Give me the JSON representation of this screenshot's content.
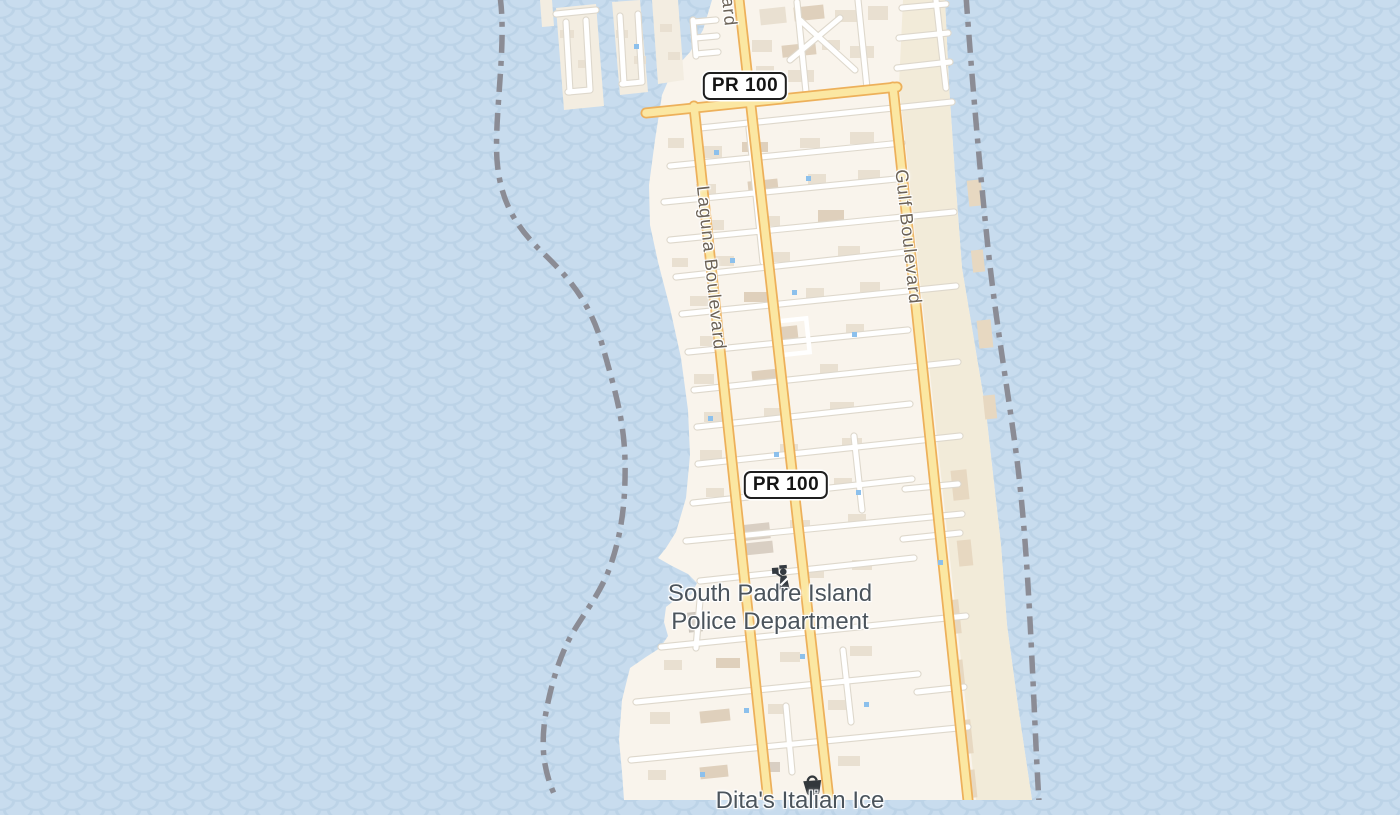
{
  "map": {
    "kind": "street-map",
    "area_shown": "South Padre Island",
    "road_labels": {
      "laguna": "Laguna Boulevard",
      "gulf": "Gulf Boulevard",
      "top_fragment": "ard"
    },
    "route_shields": [
      {
        "label": "PR 100"
      },
      {
        "label": "PR 100"
      }
    ],
    "pois": [
      {
        "label_line1": "South Padre Island",
        "label_line2": "Police Department",
        "icon": "police-officer-icon"
      },
      {
        "label": "Dita's Italian Ice",
        "icon": "shopping-basket-icon"
      }
    ],
    "colors": {
      "water": "#c8dcee",
      "wave_pattern": "#bcd3e7",
      "land_urban": "#f9f4ec",
      "land_beach": "#f2ebd9",
      "building": "#e9e0d1",
      "building_tan": "#dfd0bc",
      "major_road_fill": "#fbe7a2",
      "major_road_casing": "#edb05a",
      "minor_road": "#ffffff",
      "boundary_dash": "#8b8c95",
      "street_label": "#6b6257",
      "poi_label": "#4b545c",
      "shield_border": "#1f1f1f",
      "poi_icon": "#343a40"
    }
  }
}
